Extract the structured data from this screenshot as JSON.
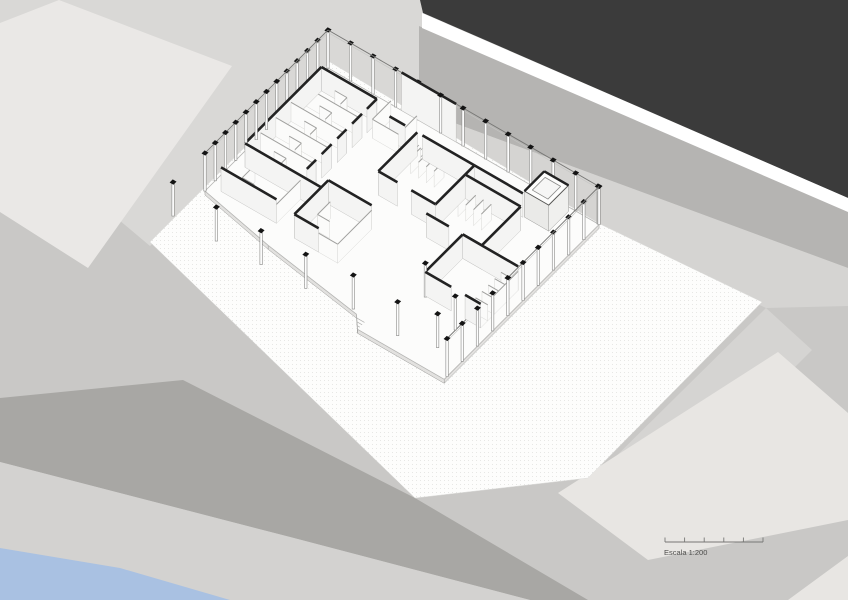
{
  "drawing": {
    "type": "architectural-axonometric",
    "description": "Axonometric site drawing of a single-storey pavilion with perimeter glass fence, interior rooms and free-standing columns on a dotted plaza"
  },
  "scalebar": {
    "label": "Escala 1:200",
    "ratio": "1:200",
    "segments": 5
  },
  "palette": {
    "background": "#c9c8c6",
    "corridor_light": "#d9d8d6",
    "dark_block": "#3b3b3b",
    "white_stripe": "#ffffff",
    "road_band": "#b5b4b2",
    "light_band_c": "#d5d4d2",
    "light_block": "#eae8e6",
    "sw_road": "#a8a7a4",
    "sw_light": "#d3d2d0",
    "water": "#a9c1e2",
    "se_block": "#e8e6e3",
    "plaza": "#fdfdfc",
    "plaza_dot": "#e7e7e5",
    "slab": "#fcfcfb",
    "slab_face": "#e2e1df",
    "wall_black": "#222222",
    "wall_face": "#f4f4f3",
    "partition_line": "#a0a09e",
    "partition_face": "#fbfbfa",
    "post_line": "#8a8a88",
    "cap_black": "#141414",
    "rail": "#777775",
    "scale_text": "#4d4d4b"
  }
}
